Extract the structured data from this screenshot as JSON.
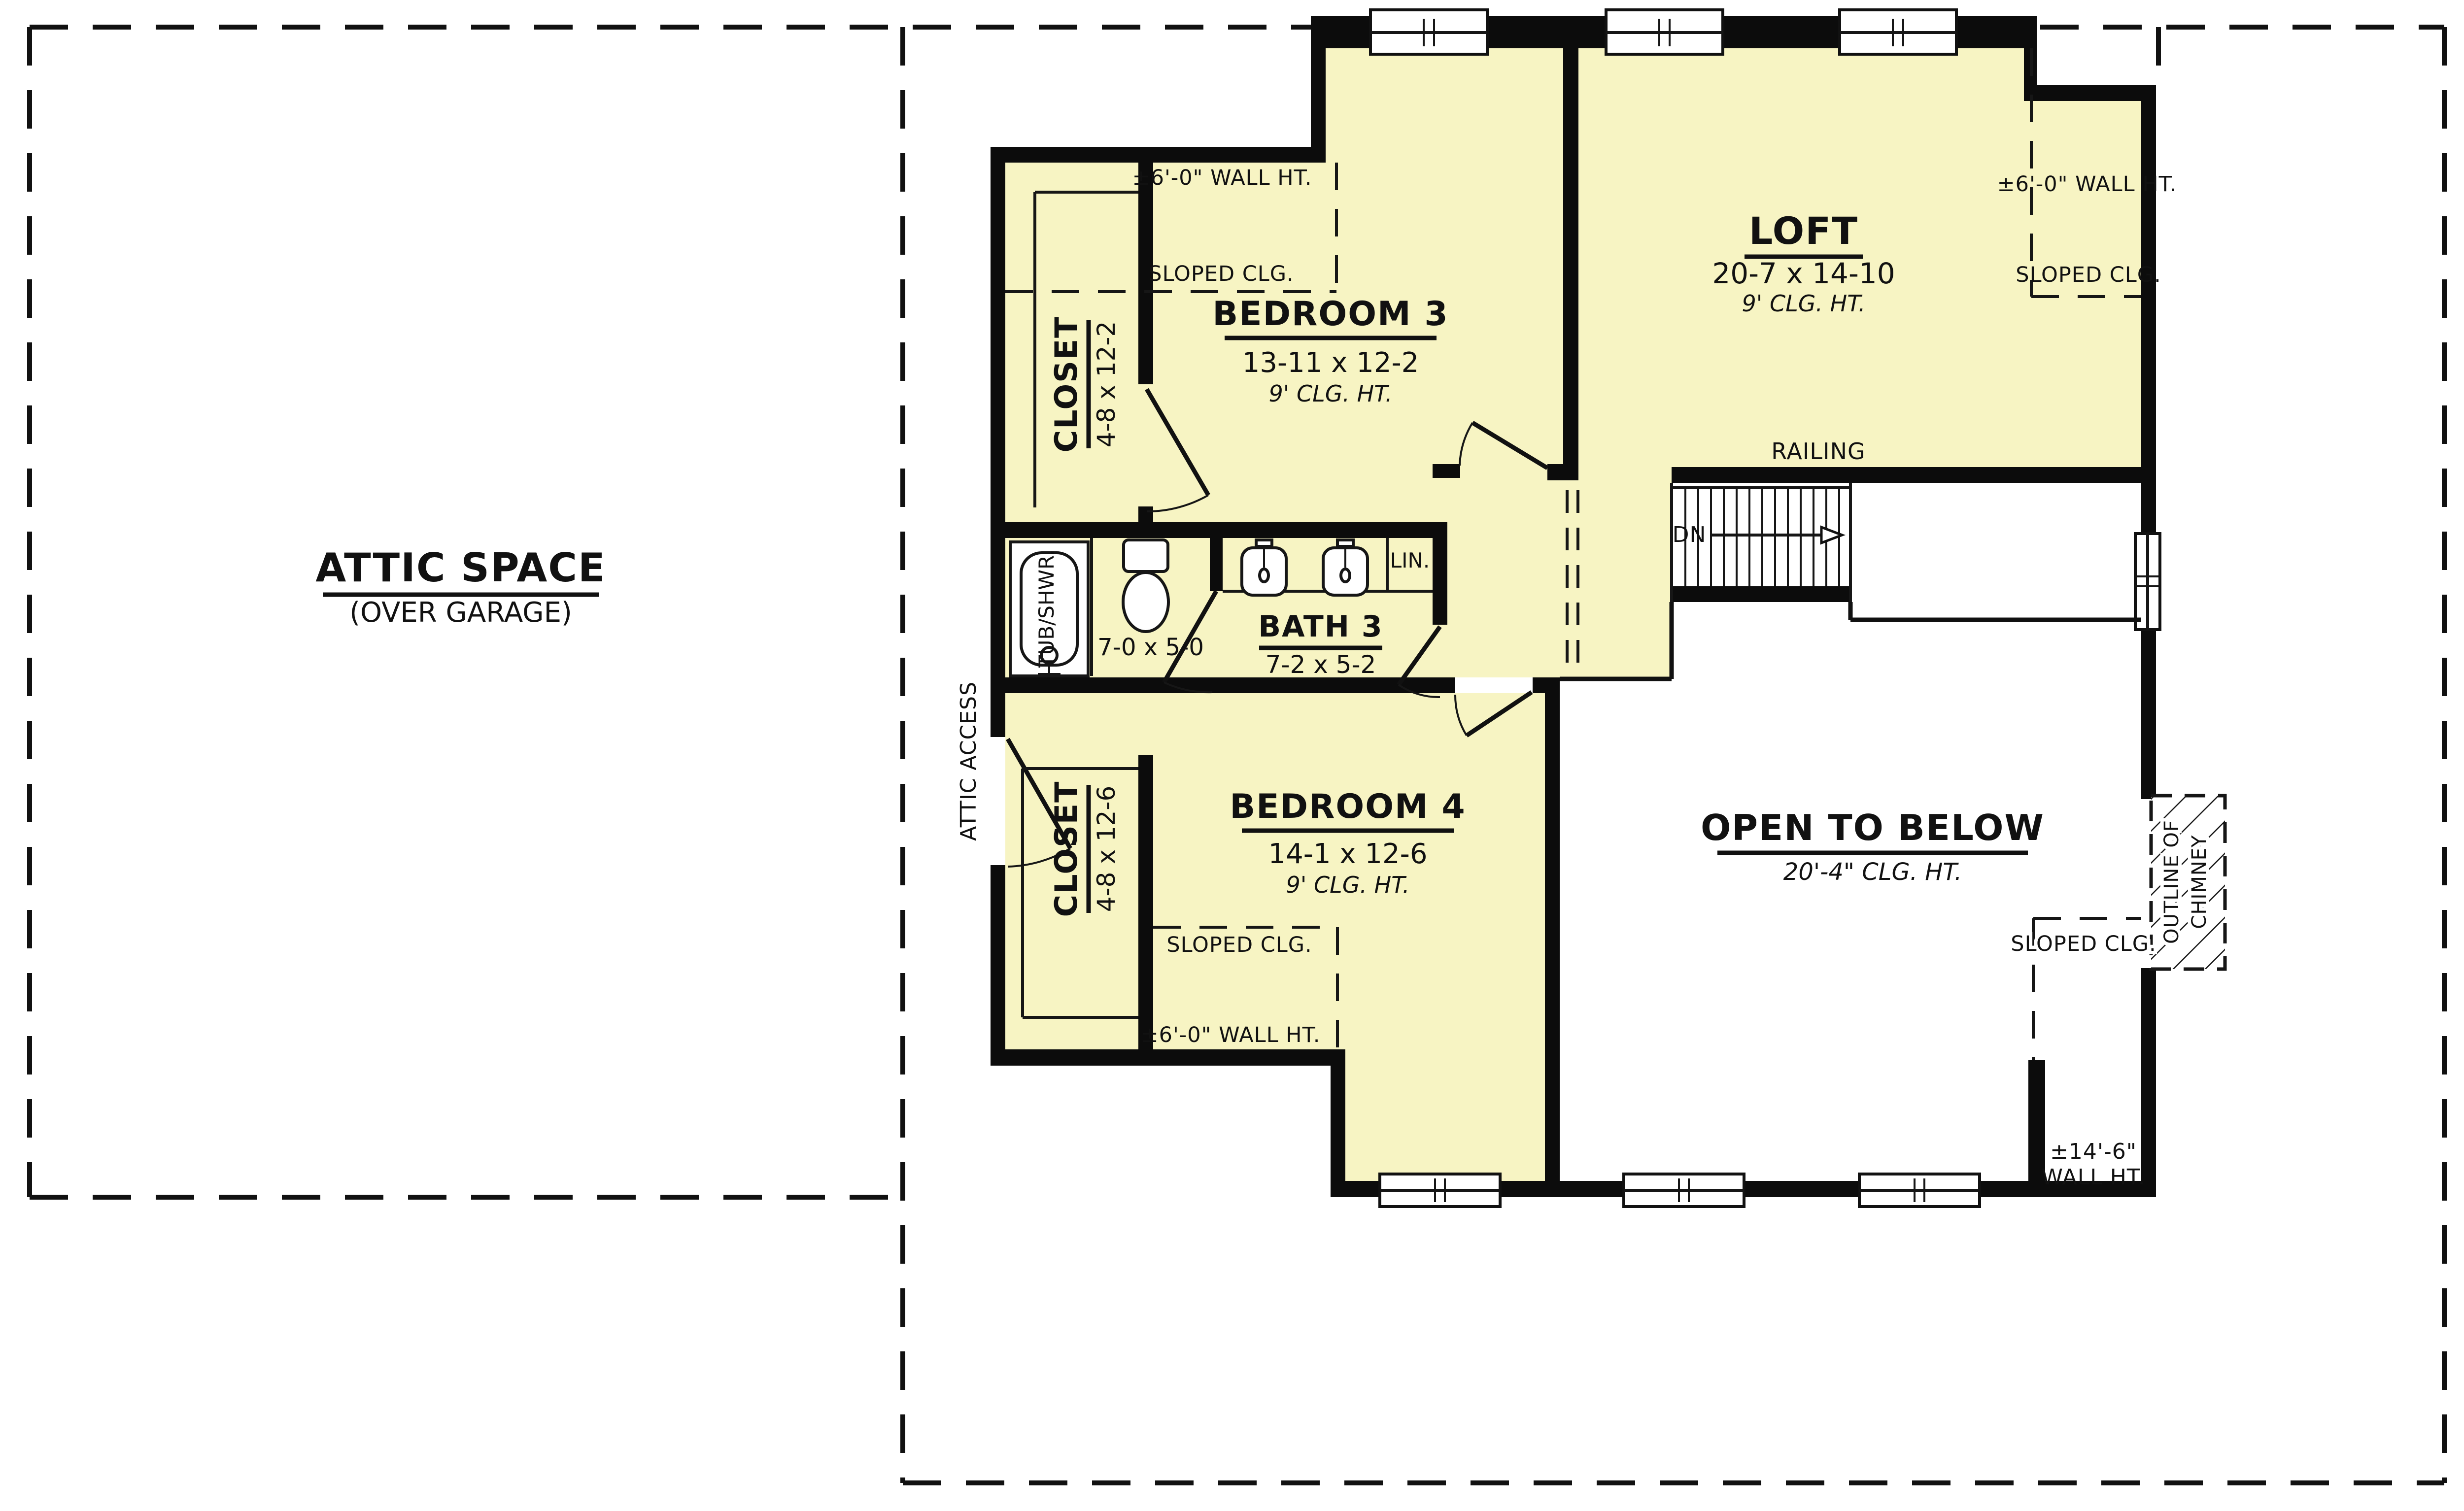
{
  "colors": {
    "background": "#ffffff",
    "room_fill": "#f7f4c3",
    "wall": "#0c0c0c",
    "line": "#161616"
  },
  "attic": {
    "title": "ATTIC SPACE",
    "subtitle": "(OVER GARAGE)"
  },
  "rooms": {
    "bedroom3": {
      "name": "BEDROOM 3",
      "dims": "13-11 x 12-2",
      "ceiling": "9' CLG. HT."
    },
    "closet3": {
      "name": "CLOSET",
      "dims": "4-8 x 12-2"
    },
    "bath3": {
      "name": "BATH 3",
      "dims": "7-2 x 5-2",
      "alcove_dims": "7-0 x 5-0",
      "tub_label": "TUB/SHWR.",
      "linen_label": "LIN."
    },
    "bedroom4": {
      "name": "BEDROOM 4",
      "dims": "14-1 x 12-6",
      "ceiling": "9' CLG. HT."
    },
    "closet4": {
      "name": "CLOSET",
      "dims": "4-8 x 12-6"
    },
    "loft": {
      "name": "LOFT",
      "dims": "20-7 x 14-10",
      "ceiling": "9' CLG. HT."
    },
    "open_to_below": {
      "name": "OPEN TO BELOW",
      "ceiling": "20'-4\" CLG. HT."
    }
  },
  "stairs": {
    "railing_label": "RAILING",
    "direction_label": "DN"
  },
  "annotations": {
    "wall_ht_6": "±6'-0\" WALL HT.",
    "sloped_clg": "SLOPED CLG.",
    "attic_access": "ATTIC ACCESS",
    "chimney_line1": "OUTLINE OF",
    "chimney_line2": "CHIMNEY",
    "wall_ht_14_line1": "±14'-6\"",
    "wall_ht_14_line2": "WALL HT."
  }
}
